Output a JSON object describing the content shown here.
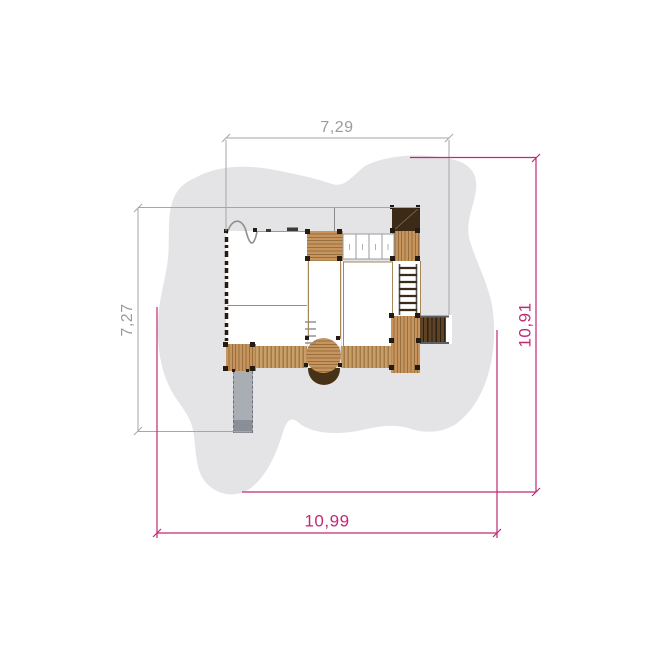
{
  "dims": {
    "top": {
      "label": "7,29"
    },
    "left": {
      "label": "7,27"
    },
    "right": {
      "label": "10,91"
    },
    "bottom": {
      "label": "10,99"
    }
  },
  "colors": {
    "dimension_accent": "#c02a74",
    "dimension_neutral": "#9b9b9b",
    "safety_zone_gray": "#e4e4e6",
    "wood_light": "#c6945c",
    "wood_plank_line": "#97703f",
    "wood_dark_roof": "#3a2a16",
    "tunnel_dark": "#473217",
    "slide_gray": "#a9aeb5",
    "post_dark": "#241c12"
  }
}
